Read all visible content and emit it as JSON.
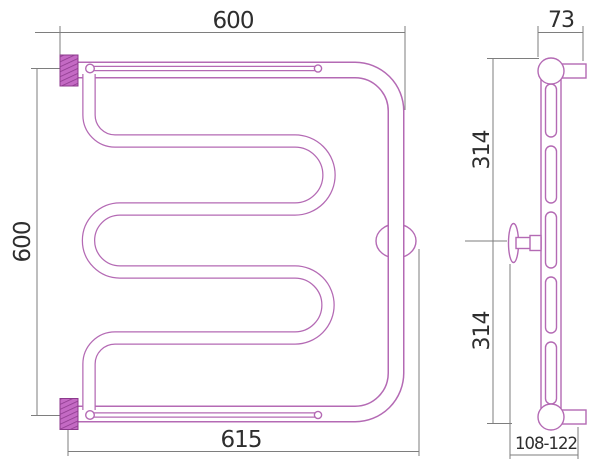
{
  "title": "Heated towel rail technical drawing",
  "views": {
    "front": {
      "label": "front-view",
      "dims": {
        "top_width": "600",
        "left_height": "600",
        "bottom_width": "615"
      }
    },
    "side": {
      "label": "side-view",
      "dims": {
        "top_depth": "73",
        "upper_height": "314",
        "lower_height": "314",
        "wall_distance": "108-122"
      }
    }
  },
  "colors": {
    "pipe_outline": "#b46ab4",
    "fitting_fill": "#c46ac4",
    "fitting_hatch": "#8d3a8d",
    "dimension_line": "#7e7e7e",
    "dimension_text": "#2e2e2e",
    "background": "#ffffff"
  }
}
